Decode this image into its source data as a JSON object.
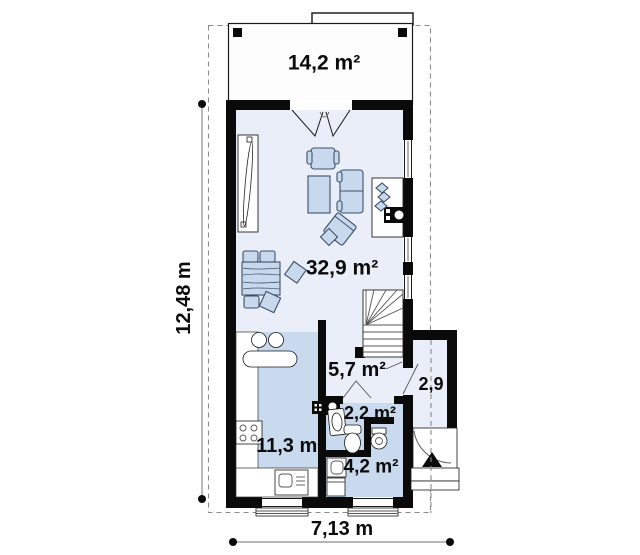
{
  "plan_title": "single-storey house floor plan",
  "rooms": {
    "terrace": "14,2 m²",
    "living": "32,9 m²",
    "kitchen": "11,3 m²",
    "hall": "5,7 m²",
    "wc": "2,2 m²",
    "bathroom": "4,2 m²",
    "porch": "2,9"
  },
  "dimensions": {
    "total_width": "7,13 m",
    "total_height": "12,48 m"
  },
  "colors": {
    "wall": "#0a0a0a",
    "floor_light": "#e9eef8",
    "floor_dark": "#c9daee",
    "furniture_fill": "#c8d9ee",
    "furniture_stroke": "#3e5068",
    "plot_line": "#8a8a8a",
    "terrace_floor": "#fdfdfd"
  }
}
